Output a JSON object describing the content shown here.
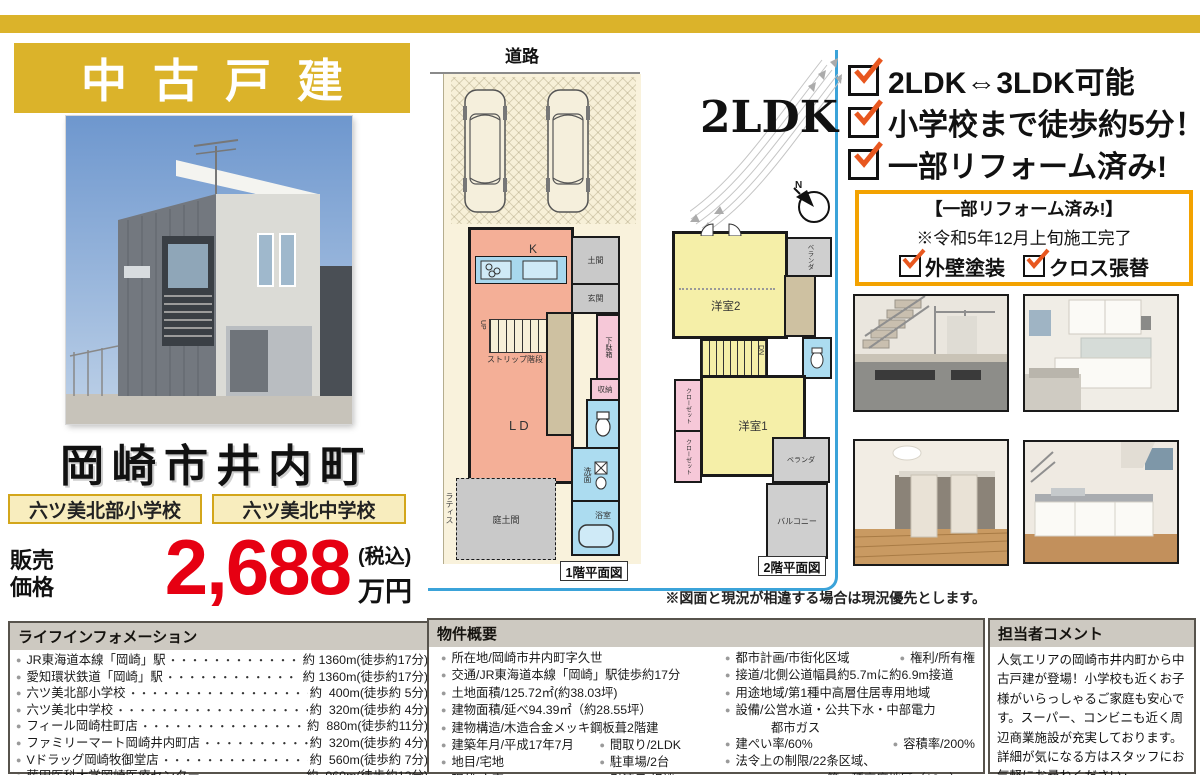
{
  "glyphs": {
    "bullet": "●",
    "leader": "・・・・・・・・・・・・・・・・・・・・・・"
  },
  "colors": {
    "gold": "#DBB32A",
    "price_red": "#E60012",
    "reform_border": "#F3A200",
    "check_orange": "#E8571F",
    "panel_blue": "#3BA3D9"
  },
  "header": {
    "banner_title": "中古戸建"
  },
  "location": {
    "name": "岡崎市井内町",
    "school_primary": "六ツ美北部小学校",
    "school_junior": "六ツ美北中学校"
  },
  "price": {
    "label_line1": "販売",
    "label_line2": "価格",
    "amount": "2,688",
    "tax_note": "(税込)",
    "unit": "万円"
  },
  "features": {
    "items": [
      "2LDK⇔3LDK可能",
      "小学校まで徒歩約5分！",
      "一部リフォーム済み!"
    ]
  },
  "reform_box": {
    "title": "【一部リフォーム済み!】",
    "note": "※令和5年12月上旬施工完了",
    "items": [
      "外壁塗装",
      "クロス張替"
    ]
  },
  "floorplan": {
    "road": "道路",
    "layout": "2LDK",
    "compass_n": "N",
    "plan1_caption": "1階平面図",
    "plan2_caption": "2階平面図",
    "disclaimer": "※図面と現況が相違する場合は現況優先とします。",
    "rooms1": {
      "k": "K",
      "ld": "LD",
      "doma": "土間",
      "genkan": "玄関",
      "getabako": "下駄箱",
      "shuno": "収納",
      "senmen": "洗面",
      "yokushitsu": "浴室",
      "niwadoma": "庭土間",
      "lattice": "ラティス",
      "stairs": "ストリップ階段",
      "up": "UP"
    },
    "rooms2": {
      "yoshitsu2": "洋室2",
      "yoshitsu1": "洋室1",
      "closet1": "クローゼット",
      "closet2": "クローゼット",
      "veranda1": "ベランダ",
      "veranda2": "ベランダ",
      "balcony": "バルコニー",
      "dn": "DN"
    }
  },
  "lifeinfo": {
    "title": "ライフインフォメーション",
    "items": [
      {
        "name": "JR東海道本線「岡崎」駅",
        "value": "約 1360m(徒歩約17分)"
      },
      {
        "name": "愛知環状鉄道「岡崎」駅",
        "value": "約 1360m(徒歩約17分)"
      },
      {
        "name": "六ツ美北部小学校",
        "value": "約  400m(徒歩約 5分)"
      },
      {
        "name": "六ツ美北中学校",
        "value": "約  320m(徒歩約 4分)"
      },
      {
        "name": "フィール岡崎柱町店",
        "value": "約  880m(徒歩約11分)"
      },
      {
        "name": "ファミリーマート岡崎井内町店",
        "value": "約  320m(徒歩約 4分)"
      },
      {
        "name": "Vドラッグ岡崎牧御堂店",
        "value": "約  560m(徒歩約 7分)"
      },
      {
        "name": "藤田医科大学岡崎医療センター",
        "value": "約  960m(徒歩約12分)"
      }
    ]
  },
  "overview": {
    "title": "物件概要",
    "colA": [
      {
        "main": "所在地/岡崎市井内町字久世"
      },
      {
        "main": "交通/JR東海道本線「岡崎」駅徒歩約17分"
      },
      {
        "main": "土地面積/125.72㎡(約38.03坪)"
      },
      {
        "main": "建物面積/延べ94.39㎡（約28.55坪）"
      },
      {
        "main": "建物構造/木造合金メッキ鋼板葺2階建"
      },
      {
        "main": "建築年月/平成17年7月",
        "sub": "間取り/2LDK"
      },
      {
        "main": "地目/宅地",
        "sub": "駐車場/2台"
      },
      {
        "main": "現状/空家",
        "sub": "引渡日/相談"
      }
    ],
    "colB": [
      {
        "main": "都市計画/市街化区域",
        "sub": "権利/所有権"
      },
      {
        "main": "接道/北側公道幅員約5.7mに約6.9m接道"
      },
      {
        "main": "用途地域/第1種中高層住居専用地域"
      },
      {
        "main": "設備/公営水道・公共下水・中部電力"
      },
      {
        "cont": "都市ガス"
      },
      {
        "main": "建ぺい率/60%",
        "sub": "容積率/200%"
      },
      {
        "main": "法令上の制限/22条区域、"
      },
      {
        "cont2": "第一種高度地区（18m）"
      },
      {
        "main": "備考/現状有姿渡し"
      }
    ]
  },
  "comment": {
    "title": "担当者コメント",
    "body": "人気エリアの岡崎市井内町から中古戸建が登場！小学校も近くお子様がいらっしゃるご家庭も安心です。スーパー、コンビニも近く周辺商業施設が充実しております。詳細が気になる方はスタッフにお気軽にお尋ねください♪"
  }
}
